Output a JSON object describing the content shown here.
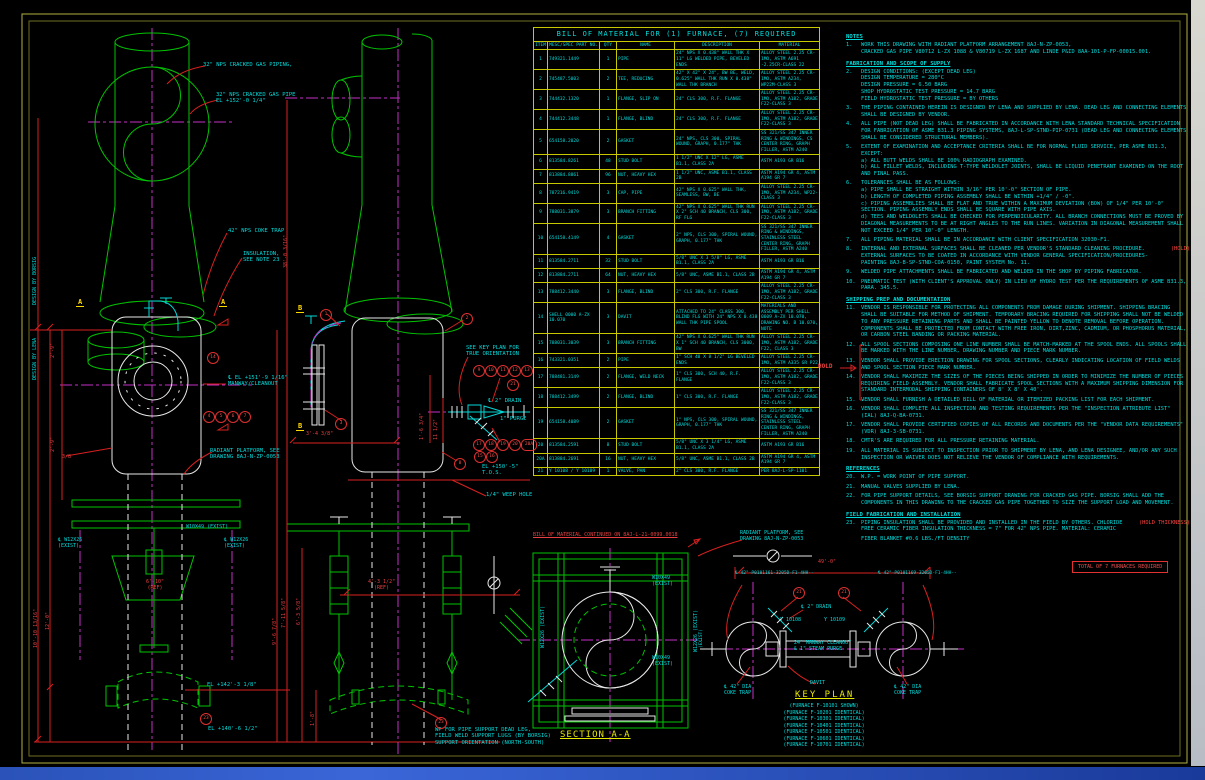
{
  "bom": {
    "title": "BILL OF MATERIAL FOR (1) FURNACE, (7) REQUIRED",
    "headers": [
      "ITEM",
      "MESC/SPEC PART NO.",
      "QTY",
      "NAME",
      "DESCRIPTION",
      "MATERIAL"
    ],
    "rows": [
      {
        "item": "1",
        "part": "749321.1449",
        "qty": "1",
        "name": "PIPE",
        "desc": "24\" NPS X 0.438\" WALL THK X 11\" LG WELDED PIPE, BEVELED ENDS",
        "mat": "ALLOY STEEL 2.25 CR-1MO, ASTM A691 -2.25CR-CLASS 22"
      },
      {
        "item": "2",
        "part": "745487.5003",
        "qty": "2",
        "name": "TEE, REDUCING",
        "desc": "42\" X 42\" X 24\", BW BE, WELD, 0.625\" WALL THK RUN X 0.438\" WALL THK BRANCH",
        "mat": "ALLOY STEEL 2.25 CR-1MO, ASTM A234, WP22M-CLASS 3"
      },
      {
        "item": "3",
        "part": "744432.1320",
        "qty": "1",
        "name": "FLANGE, SLIP ON",
        "desc": "24\" CLS 300, R.F. FLANGE",
        "mat": "ALLOY STEEL 2.25 CR-1MO, ASTM A182, GRADE F22-CLASS 3"
      },
      {
        "item": "4",
        "part": "744412.3448",
        "qty": "1",
        "name": "FLANGE, BLIND",
        "desc": "24\" CLS 300, R.F. FLANGE",
        "mat": "ALLOY STEEL 2.25 CR-1MO, ASTM A182, GRADE F22-CLASS 3"
      },
      {
        "item": "5",
        "part": "654158.2020",
        "qty": "2",
        "name": "GASKET",
        "desc": "24\" NPS, CLS 300, SPIRAL WOUND, GRAPH, 0.177\" THK",
        "mat": "SS 321/SS 347 INNER RING & WINDINGS, CS CENTER RING, GRAPH FILLER, ASTM A240"
      },
      {
        "item": "6",
        "part": "813584.8261",
        "qty": "48",
        "name": "STUD BOLT",
        "desc": "1 1/2\" UNC X 12\" LG, ASME B1.1, CLASS 2A",
        "mat": "ASTM A193 GR B16"
      },
      {
        "item": "7",
        "part": "813884.8861",
        "qty": "96",
        "name": "NUT, HEAVY HEX",
        "desc": "1 1/2\" UNC, ASME B1.1, CLASS 2B",
        "mat": "ASTM A194 GR 4, ASTM A194 GR 7"
      },
      {
        "item": "8",
        "part": "787216.9419",
        "qty": "3",
        "name": "CAP, PIPE",
        "desc": "42\" NPS X 0.625\" WALL THK, SEAMLESS, BW, BE",
        "mat": "ALLOY STEEL 2.25 CR-1MO, ASTM A234, WP22-CLASS 3"
      },
      {
        "item": "9",
        "part": "788031.3879",
        "qty": "3",
        "name": "BRANCH FITTING",
        "desc": "42\" NPS X 0.625\" WALL THK RUN X 2\" SCH 40 BRANCH, CLS 300, RF FLG",
        "mat": "ALLOY STEEL 2.25 CR-1MO, ASTM A182, GRADE F22-CLASS 3"
      },
      {
        "item": "10",
        "part": "654158.4149",
        "qty": "4",
        "name": "GASKET",
        "desc": "2\" NPS, CLS 300, SPIRAL WOUND, GRAPH, 0.177\" THK",
        "mat": "SS 321/SS 347 INNER RING & WINDINGS, STAINLESS STEEL CENTER RING, GRAPH FILLER, ASTM A240"
      },
      {
        "item": "11",
        "part": "813584.2711",
        "qty": "32",
        "name": "STUD BOLT",
        "desc": "5/8\" UNC X 3 5/8\" LG, ASME B1.1, CLASS 2A",
        "mat": "ASTM A193 GR B16"
      },
      {
        "item": "12",
        "part": "813884.2711",
        "qty": "64",
        "name": "NUT, HEAVY HEX",
        "desc": "5/8\" UNC, ASME B1.1, CLASS 2B",
        "mat": "ASTM A194 GR 4, ASTM A194 GR 7"
      },
      {
        "item": "13",
        "part": "788412.3440",
        "qty": "3",
        "name": "FLANGE, BLIND",
        "desc": "2\" CLS 300, R.F. FLANGE",
        "mat": "ALLOY STEEL 2.25 CR-1MO, ASTM A182, GRADE F22-CLASS 3"
      },
      {
        "item": "14",
        "part": "SHELL 0000 A-ZX 10.070",
        "qty": "3",
        "name": "DAVIT",
        "desc": "ATTACHED TO 24\" CLASS 300, BLIND FLG WITH 24\" NPS X 0.438 WALL THK PIPE SPOOL",
        "mat": "MATERIALS AND ASSEMBLY PER SHELL 0609 A-ZX 10.070, DRAWING NO. B 10.070, NOTE"
      },
      {
        "item": "15",
        "part": "788031.3039",
        "qty": "3",
        "name": "BRANCH FITTING",
        "desc": "42\" NPS X 0.625\" WALL THK RUN X 1\" SCH 40 BRANCH, CLS 3000, BW",
        "mat": "ALLOY STEEL 2.25 CR-1MO, ASTM A182, GRADE F22, CLASS 3"
      },
      {
        "item": "16",
        "part": "743321.0351",
        "qty": "2",
        "name": "PIPE",
        "desc": "1\" SCH 40 X 8 1/2\" LG BEVELED ENDS",
        "mat": "ALLOY STEEL 2.25 CR-1MO, ASTM A335 GR P22"
      },
      {
        "item": "17",
        "part": "788481.3149",
        "qty": "2",
        "name": "FLANGE, WELD NECK",
        "desc": "1\" CLS 300, SCH 40, R.F. FLANGE",
        "mat": "ALLOY STEEL 2.25 CR-1MO, ASTM A182, GRADE F22-CLASS 3"
      },
      {
        "item": "18",
        "part": "788412.3499",
        "qty": "2",
        "name": "FLANGE, BLIND",
        "desc": "1\" CLS 300, R.F. FLANGE",
        "mat": "ALLOY STEEL 2.25 CR-1MO, ASTM A182, GRADE F22-CLASS 3"
      },
      {
        "item": "19",
        "part": "654158.4089",
        "qty": "2",
        "name": "GASKET",
        "desc": "1\" NPS, CLS 300, SPIRAL WOUND, GRAPH, 0.177\" THK",
        "mat": "SS 321/SS 347 INNER RING & WINDINGS, STAINLESS STEEL CENTER RING, GRAPH FILLER, ASTM A240"
      },
      {
        "item": "20",
        "part": "813584.2591",
        "qty": "8",
        "name": "STUD BOLT",
        "desc": "5/8\" UNC X 3 1/4\" LG, ASME B1.1, CLASS 2A",
        "mat": "ASTM A193 GR B16"
      },
      {
        "item": "20A",
        "part": "813884.2691",
        "qty": "16",
        "name": "NUT, HEAVY HEX",
        "desc": "5/8\" UNC, ASME B1.1, CLASS 2B",
        "mat": "ASTM A194 GR 4, ASTM A194 GR 7"
      },
      {
        "item": "21",
        "part": "Y 10108 / Y 10109",
        "qty": "1",
        "name": "VALVE, PAN",
        "desc": "2\" CLS 300, R.F. FLANGE",
        "mat": "PER 8AJ-L-SP-1101"
      }
    ],
    "continued": "BILL OF MATERIAL CONTINUED ON 8AJ-L-21-0099.0018"
  },
  "notes": {
    "s0_heading": "NOTES",
    "s0": [
      {
        "n": "1.",
        "t": "WORK THIS DRAWING WITH RADIANT PLATFORM ARRANGEMENT 8AJ-N-ZP-0053,\nCRACKED GAS PIPE V80712 L-ZX 1088 & V80719 L-ZX 1687 AND LINDE P&ID 8AA-101-P-FP-00015.001.",
        "hold": ""
      }
    ],
    "s1_heading": "FABRICATION AND SCOPE OF SUPPLY",
    "s1": [
      {
        "n": "2.",
        "t": "DESIGN CONDITIONS: (EXCEPT DEAD LEG)\nDESIGN TEMPERATURE = 280°C\nDESIGN PRESSURE = 6.50 BARG\nSHOP HYDROSTATIC TEST PRESSURE = 14.7 BARG\nFIELD HYDROSTATIC TEST PRESSURE = BY OTHERS",
        "hold": ""
      },
      {
        "n": "3.",
        "t": "THE PIPING CONTAINED HEREIN IS DESIGNED BY LENA AND SUPPLIED BY LENA. DEAD LEG AND CONNECTING ELEMENTS SHALL BE DESIGNED BY VENDOR.",
        "hold": ""
      },
      {
        "n": "4.",
        "t": "ALL PIPE (NOT DEAD LEG) SHALL BE FABRICATED IN ACCORDANCE WITH LENA STANDARD TECHNICAL SPECIFICATION FOR FABRICATION OF ASME B31.3 PIPING SYSTEMS, 8AJ-L-SP-STND-PIP-0731 (DEAD LEG AND CONNECTING ELEMENTS SHALL BE CONSIDERED STRUCTURAL MEMBERS).",
        "hold": ""
      },
      {
        "n": "5.",
        "t": "EXTENT OF EXAMINATION AND ACCEPTANCE CRITERIA SHALL BE FOR NORMAL FLUID SERVICE, PER ASME B31.3, EXCEPT:\na) ALL BUTT WELDS SHALL BE 100% RADIOGRAPH EXAMINED.\nb) ALL FILLET WELDS, INCLUDING T-TYPE WELDOLET JOINTS, SHALL BE LIQUID PENETRANT EXAMINED ON THE ROOT AND FINAL PASS.",
        "hold": ""
      },
      {
        "n": "6.",
        "t": "TOLERANCES SHALL BE AS FOLLOWS:\na) PIPE SHALL BE STRAIGHT WITHIN 3/16\" PER 10'-0\" SECTION OF PIPE.\nb) LENGTH OF COMPLETED PIPING ASSEMBLY SHALL BE WITHIN +1/4\" / -0\".\nc) PIPING ASSEMBLIES SHALL BE FLAT AND TRUE WITHIN A MAXIMUM DEVIATION (BOW) OF 1/4\" PER 10'-0\" SECTION. PIPING ASSEMBLY ENDS SHALL BE SQUARE WITH PIPE AXIS.\nd) TEES AND WELDOLETS SHALL BE CHECKED FOR PERPENDICULARITY. ALL BRANCH CONNECTIONS MUST BE PROVED BY DIAGONAL MEASUREMENTS TO BE AT RIGHT ANGLES TO THE RUN LINES. VARIATION IN DIAGONAL MEASUREMENT SHALL NOT EXCEED 1/4\" PER 10'-0\" LENGTH.",
        "hold": ""
      },
      {
        "n": "7.",
        "t": "ALL PIPING MATERIAL SHALL BE IN ACCORDANCE WITH CLIENT SPECIFICATION 32030-F1.",
        "hold": ""
      },
      {
        "n": "8.",
        "t": "INTERNAL AND EXTERNAL SURFACES SHALL BE CLEANED PER VENDOR'S STANDARD CLEANING PROCEDURE. EXTERNAL SURFACES TO BE COATED IN ACCORDANCE WITH VENDOR GENERAL SPECIFICATION/PROCEDURES-PAINTING 8AJ-B-SP-STND-COA-0150, PAINT SYSTEM No. 11.",
        "hold": "(HOLD)"
      },
      {
        "n": "9.",
        "t": "WELDED PIPE ATTACHMENTS SHALL BE FABRICATED AND WELDED IN THE SHOP BY PIPING FABRICATOR.",
        "hold": ""
      },
      {
        "n": "10.",
        "t": "PNEUMATIC TEST (WITH CLIENT'S APPROVAL ONLY) IN LIEU OF HYDRO TEST PER THE REQUIREMENTS OF ASME B31.3, PARA. 345.5.",
        "hold": ""
      }
    ],
    "s2_heading": "SHIPPING PREP AND DOCUMENTATION",
    "s2": [
      {
        "n": "11.",
        "t": "VENDOR IS RESPONSIBLE FOR PROTECTING ALL COMPONENTS FROM DAMAGE DURING SHIPMENT. SHIPPING BRACING SHALL BE SUITABLE FOR METHOD OF SHIPMENT. TEMPORARY BRACING REQUIRED FOR SHIPPING SHALL NOT BE WELDED TO ANY PRESSURE RETAINING PARTS AND SHALL BE PAINTED YELLOW TO DENOTE REMOVAL BEFORE OPERATION. COMPONENTS SHALL BE PROTECTED FROM CONTACT WITH FREE IRON, DIRT,ZINC, CADMIUM, OR PHOSPHORUS MATERIAL, OR CARBON STEEL BANDING OR PACKING MATERIAL.",
        "hold": ""
      },
      {
        "n": "12.",
        "t": "ALL SPOOL SECTIONS COMPOSING ONE LINE NUMBER SHALL BE MATCH-MARKED AT THE SPOOL ENDS. ALL SPOOLS SHALL BE MARKED WITH THE LINE NUMBER, DRAWING NUMBER AND PIECE MARK NUMBER.",
        "hold": ""
      },
      {
        "n": "13.",
        "t": "VENDOR SHALL PROVIDE ERECTION DRAWING FOR SPOOL SECTIONS, CLEARLY INDICATING LOCATION OF FIELD WELDS AND SPOOL SECTION PIECE MARK NUMBER.",
        "hold": ""
      },
      {
        "n": "14.",
        "t": "VENDOR SHALL MAXIMIZE THE SIZES OF THE PIECES BEING SHIPPED IN ORDER TO MINIMIZE THE NUMBER OF PIECES REQUIRING FIELD ASSEMBLY. VENDOR SHALL FABRICATE SPOOL SECTIONS WITH A MAXIMUM SHIPPING DIMENSION FOR STANDARD INTERMODAL SHIPPING CONTAINERS OF 8' X 8' X 40'.",
        "hold": ""
      },
      {
        "n": "15.",
        "t": "VENDOR SHALL FURNISH A DETAILED BILL OF MATERIAL OR ITEMIZED PACKING LIST FOR EACH SHIPMENT.",
        "hold": ""
      },
      {
        "n": "16.",
        "t": "VENDOR SHALL COMPLETE ALL INSPECTION AND TESTING REQUIREMENTS PER THE \"INSPECTION ATTRIBUTE LIST\" (IAL) 8AJ-Q-BA-0731.",
        "hold": ""
      },
      {
        "n": "17.",
        "t": "VENDOR SHALL PROVIDE CERTIFIED COPIES OF ALL RECORDS AND DOCUMENTS PER THE \"VENDOR DATA REQUIREMENTS\" (VDR) 8AJ-3-SB-0731.",
        "hold": ""
      },
      {
        "n": "18.",
        "t": "CMTR'S ARE REQUIRED FOR ALL PRESSURE RETAINING MATERIAL.",
        "hold": ""
      },
      {
        "n": "19.",
        "t": "ALL MATERIAL IS SUBJECT TO INSPECTION PRIOR TO SHIPMENT BY LENA, AND LENA DESIGNEE, AND/OR ANY SUCH INSPECTION OR WAIVER DOES NOT RELIEVE THE VENDOR OF COMPLIANCE WITH REQUIREMENTS.",
        "hold": ""
      }
    ],
    "s3_heading": "REFERENCES",
    "s3": [
      {
        "n": "20.",
        "t": "W.P. = WORK POINT OF PIPE SUPPORT.",
        "hold": ""
      },
      {
        "n": "21.",
        "t": "MANUAL VALVES SUPPLIED BY LENA.",
        "hold": ""
      },
      {
        "n": "22.",
        "t": "FOR PIPE SUPPORT DETAILS, SEE BORSIG SUPPORT DRAWING FOR CRACKED GAS PIPE. BORSIG SHALL ADD THE COMPONENTS IN THIS DRAWING TO THE CRACKED GAS PIPE TOGETHER TO SIZE THE SUPPORT LOAD AND MOVEMENT.",
        "hold": ""
      }
    ],
    "s4_heading": "FIELD FABRICATION AND INSTALLATION",
    "s4": [
      {
        "n": "23.",
        "t": "PIPING INSULATION SHALL BE PROVIDED AND INSTALLED IN THE FIELD BY OTHERS. CHLORIDE FREE CERAMIC FIBER INSULATION THICKNESS = 7\" FOR 42\" NPS PIPE. MATERIAL: CERAMIC",
        "hold": "(HOLD THICKNESS)"
      },
      {
        "n": "",
        "t": "FIBER BLANKET #0.6 LBS./FT DENSITY",
        "hold": ""
      }
    ]
  },
  "hold_flag": "HOLD",
  "total_box": "TOTAL OF 7 FURNACES REQUIRED",
  "labels": {
    "lv_pipe1": "32\" NPS CRACKED GAS PIPING,",
    "lv_pipe2": "32\" NPS CRACKED GAS PIPE\nEL +152'-0 1/4\"",
    "lv_coke": "42\" NPS COKE TRAP",
    "lv_insul": "INSULATION,\nSEE NOTE 23",
    "lv_manway": "℄ EL +151'-9 1/16\"\nMANWAY/CLEANOUT",
    "lv_platform": "RADIANT PLATFORM, SEE\nDRAWING 8AJ-N-ZP-0053",
    "lv_w10": "W10X49 (EXIST)",
    "lv_w12l": "℄ W12X26\n(EXIST)",
    "lv_w12r": "℄ W12X26\n(EXIST)",
    "lv_ref": "6'-10\"\n(REF)",
    "lv_el1": "EL +142'-3 1/8\"",
    "lv_el2": "EL +140'-6 1/2\"",
    "design_lena": "DESIGN BY LENA",
    "design_borsig": "DESIGN BY BORSIG",
    "dim_2_9a": "2'-9\"",
    "dim_2_9b": "2'-9\"",
    "dim_38": "3/8",
    "dim_l1": "10'-10 13/16\"",
    "dim_l2": "12'-0\"",
    "dim_r1": "9'-6 7/8\"",
    "mv_tall_dim": "38'-0 3/16\"",
    "mv_see_key": "SEE KEY PLAN FOR\nTRUE ORIENTATION",
    "mv_drain": "℄ 2\" DRAIN",
    "mv_purge": "1\" PURGE",
    "mv_tos": "EL +150'-5\"\nT.O.S.",
    "mv_weep": "1/4\" WEEP HOLE",
    "mv_dim_w": "3'-4 3/8\"",
    "mv_dim1": "1'-6 3/4\"",
    "mv_dim2": "11 1/2\"",
    "mv_dim_ref": "4'-3 1/2\"\n(REF)",
    "mv_v1": "7'-11 5/8\"",
    "mv_v2": "6'-3 5/8\"",
    "mv_v3": "1'-8\"",
    "wp_note": "WP FOR PIPE SUPPORT DEAD LEG,\nFIELD WELD SUPPORT LUGS (BY BORSIG)\nSUPPORT ORIENTATION (NORTH-SOUTH)",
    "flag_a": "A",
    "flag_b": "B"
  },
  "section_aa": {
    "title": "SECTION A-A",
    "w10a": "W10X49\n(EXIST)",
    "w10b": "W10X49\n(EXIST)",
    "w12l": "W12X26 (EXIST)",
    "w12r": "W12X26 (EXIST)"
  },
  "key_plan": {
    "title": "KEY PLAN",
    "platform": "RADIANT PLATFORM, SEE\nDRAWING 8AJ-N-ZP-0053",
    "dim": "49'-0\"",
    "line_l": "℄ 42\"-P0101161-3205D-F1-4HH--",
    "line_r": "℄ 42\"-P0101169-3205D-F1-4HH--",
    "drain": "℄ 2\" DRAIN",
    "y1": "Y 10108",
    "y2": "Y 10109",
    "manway": "24\" MANWAY CLEANOUT\n& 1\" STEAM PURGE",
    "davit": "DAVIT",
    "coke_l": "℄ 42\" DIA\nCOKE TRAP",
    "coke_r": "℄ 42\" DIA\nCOKE TRAP",
    "exist": "(EXIST)",
    "furnaces": [
      "(FURNACE F-10101 SHOWN)",
      "(FURNACE F-10201 IDENTICAL)",
      "(FURNACE F-10301 IDENTICAL)",
      "(FURNACE F-10401 IDENTICAL)",
      "(FURNACE F-10501 IDENTICAL)",
      "(FURNACE F-10601 IDENTICAL)",
      "(FURNACE F-10701 IDENTICAL)"
    ]
  },
  "balloons": {
    "l14": "14",
    "l4": "4",
    "l5": "5",
    "l6": "6",
    "l7": "7",
    "l23": "23",
    "m1": "1",
    "m2": "2",
    "m3": "3",
    "m8": "8",
    "m9": "9",
    "m10": "10",
    "m11": "11",
    "m12": "12",
    "m13": "13",
    "m21": "21",
    "m15": "15",
    "m16": "16",
    "m17": "17",
    "m18": "18",
    "m19": "19",
    "m20": "20",
    "m20a": "20A",
    "m23": "23",
    "k21a": "21",
    "k21b": "21"
  },
  "colors": {
    "background": "#000000",
    "grid_yellow": "#c8c800",
    "text_cyan": "#00dcdc",
    "line_green": "#00c400",
    "centerline_magenta": "#c430c4",
    "dimension_red": "#d82020",
    "highlight_yellow": "#e8e800",
    "white": "#e8e8e8"
  }
}
